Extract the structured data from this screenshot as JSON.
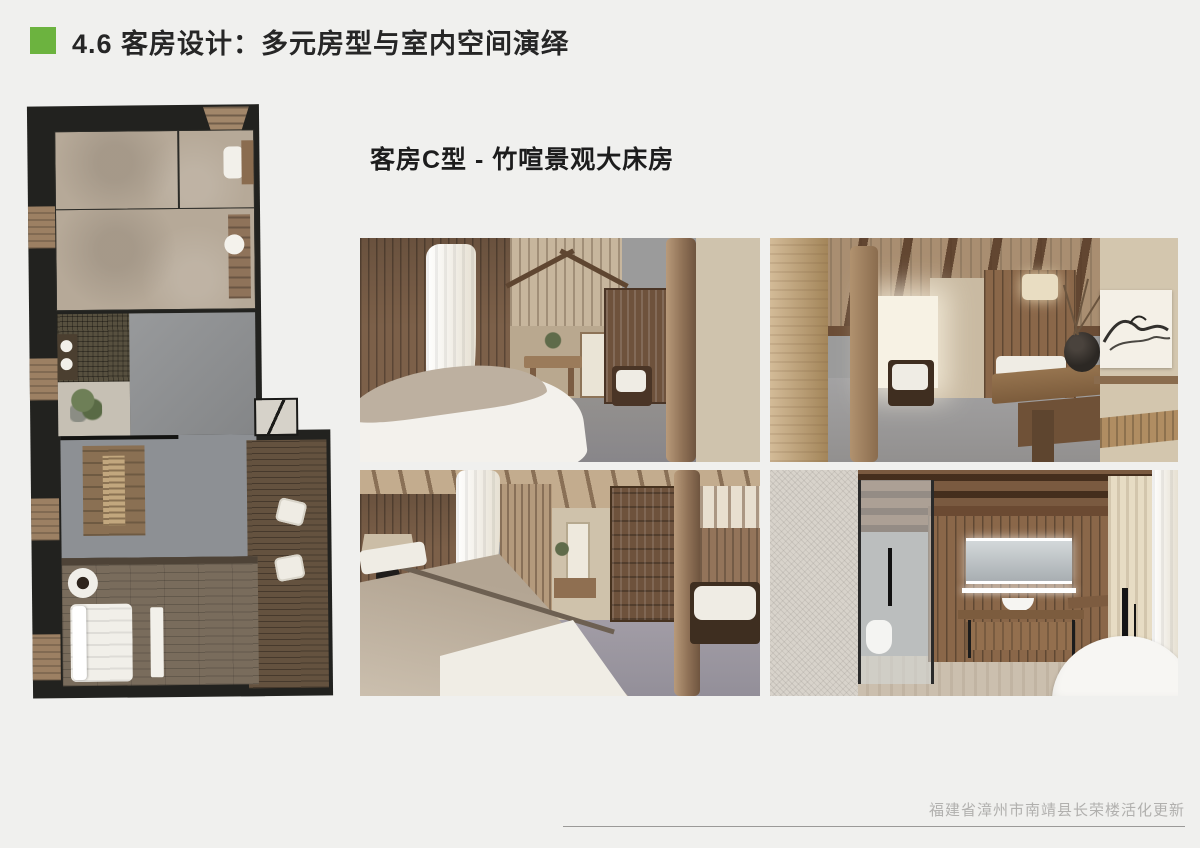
{
  "slide": {
    "title": "4.6 客房设计：多元房型与室内空间演绎",
    "subtitle": "客房C型 - 竹喧景观大床房",
    "footer": "福建省漳州市南靖县长荣楼活化更新",
    "accent_color": "#6cb33f"
  }
}
